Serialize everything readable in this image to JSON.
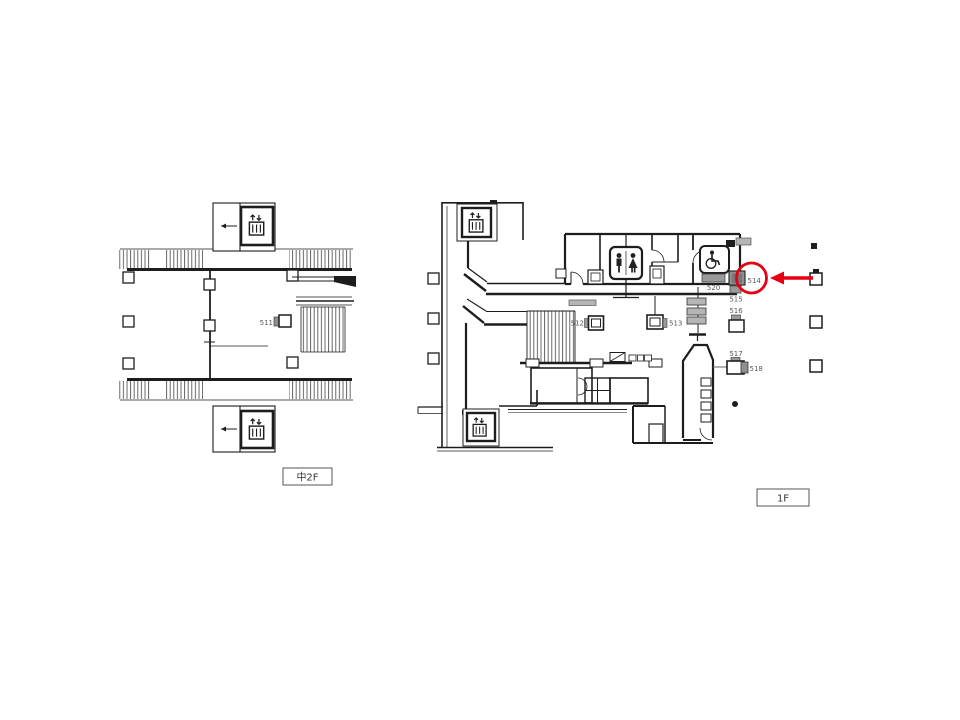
{
  "document": {
    "type": "station-floor-map",
    "background": "#ffffff"
  },
  "palette": {
    "wall": "#1d1d1d",
    "hatch": "#565656",
    "sign_dark_gray": "#8f8f8f",
    "sign_light_gray": "#b5b5b5",
    "label_text": "#595959",
    "annotation_red": "#e60012"
  },
  "plans": {
    "mezzanine": {
      "floor_label": "中2F",
      "signs": [
        {
          "id": "511"
        }
      ],
      "icons": [
        "elevator-icon",
        "elevator-icon"
      ]
    },
    "first_floor": {
      "floor_label": "1F",
      "signs": [
        {
          "id": "512"
        },
        {
          "id": "513"
        },
        {
          "id": "514"
        },
        {
          "id": "515"
        },
        {
          "id": "516"
        },
        {
          "id": "517"
        },
        {
          "id": "518"
        },
        {
          "id": "520"
        }
      ],
      "icons": [
        "elevator-icon",
        "elevator-icon",
        "toilet-icon",
        "wheelchair-icon"
      ]
    }
  },
  "annotation": {
    "shape": "circle",
    "target_sign": "514",
    "arrow_direction": "left",
    "color": "#e60012"
  }
}
